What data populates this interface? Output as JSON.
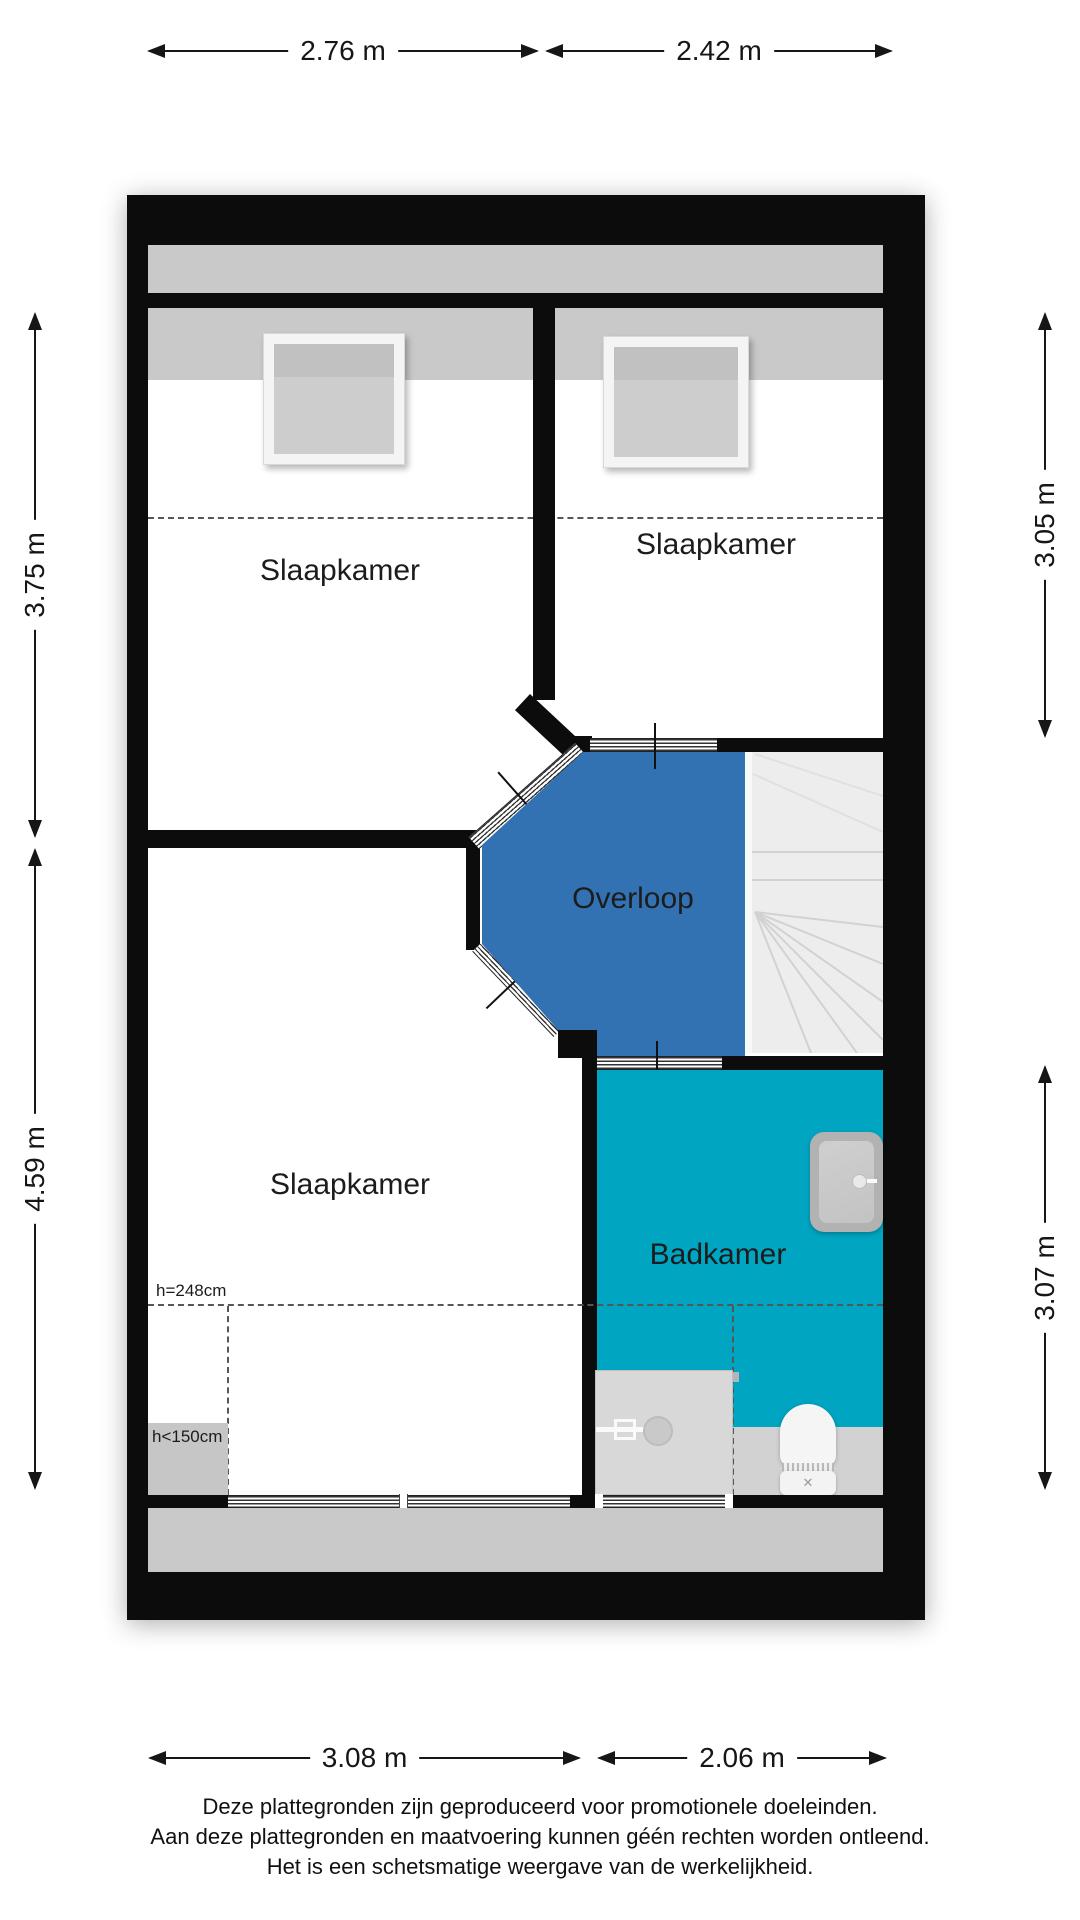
{
  "colors": {
    "overloop": "#3272b3",
    "badkamer": "#00a5c1",
    "wall": "#0c0c0c",
    "roof_zone": "#c9c9c9",
    "low_zone": "#c6c6c6",
    "bath_low_zone": "#d2d2d2",
    "stairs": "#ededed",
    "dimension": "#161616"
  },
  "dimensions": {
    "top": [
      {
        "label": "2.76 m"
      },
      {
        "label": "2.42 m"
      }
    ],
    "bottom": [
      {
        "label": "3.08 m"
      },
      {
        "label": "2.06 m"
      }
    ],
    "left": [
      {
        "label": "3.75 m"
      },
      {
        "label": "4.59 m"
      }
    ],
    "right": [
      {
        "label": "3.05 m"
      },
      {
        "label": "3.07 m"
      }
    ]
  },
  "rooms": {
    "bedroom_top_left": {
      "label": "Slaapkamer"
    },
    "bedroom_top_right": {
      "label": "Slaapkamer"
    },
    "bedroom_bottom_left": {
      "label": "Slaapkamer"
    },
    "landing": {
      "label": "Overloop"
    },
    "bathroom": {
      "label": "Badkamer"
    }
  },
  "annotations": {
    "ceiling_height": "h=248cm",
    "low_ceiling": "h<150cm"
  },
  "icons": {
    "toilet_flush_icon": "✕"
  },
  "disclaimer": {
    "line1": "Deze plattegronden zijn geproduceerd voor promotionele doeleinden.",
    "line2": "Aan deze plattegronden en maatvoering kunnen géén rechten worden ontleend.",
    "line3": "Het is een schetsmatige weergave van de werkelijkheid."
  }
}
